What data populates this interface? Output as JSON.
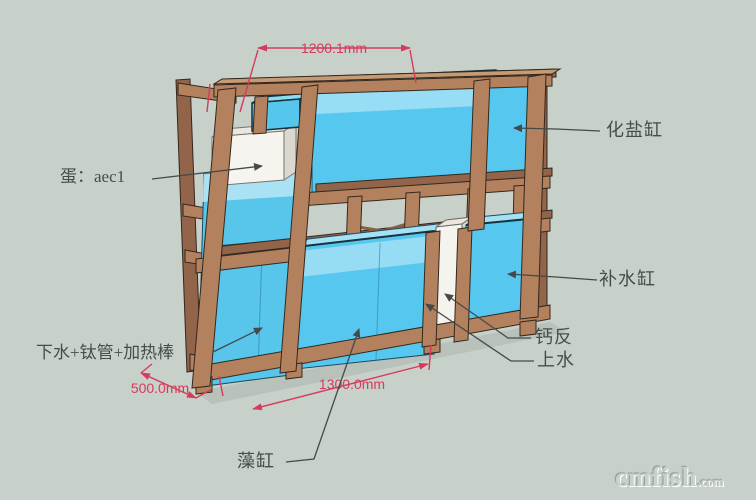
{
  "scene": {
    "background_color": "#c8d0ca",
    "wood_color": "#b3815d",
    "tank_color": "#56c7ee",
    "dimension_color": "#d63a5c"
  },
  "labels": {
    "salt_tank": "化盐缸",
    "skimmer": "蛋：aec1",
    "topup_tank": "补水缸",
    "calcium_reactor": "钙反",
    "water_up": "上水",
    "drain_note": "下水+钛管+加热棒",
    "algae_tank": "藻缸"
  },
  "dimensions": {
    "top_width": "1200.1mm",
    "depth": "500.0mm",
    "bottom_width": "1300.0mm"
  },
  "watermark": {
    "brand": "cmfish",
    "domain": ".com"
  }
}
